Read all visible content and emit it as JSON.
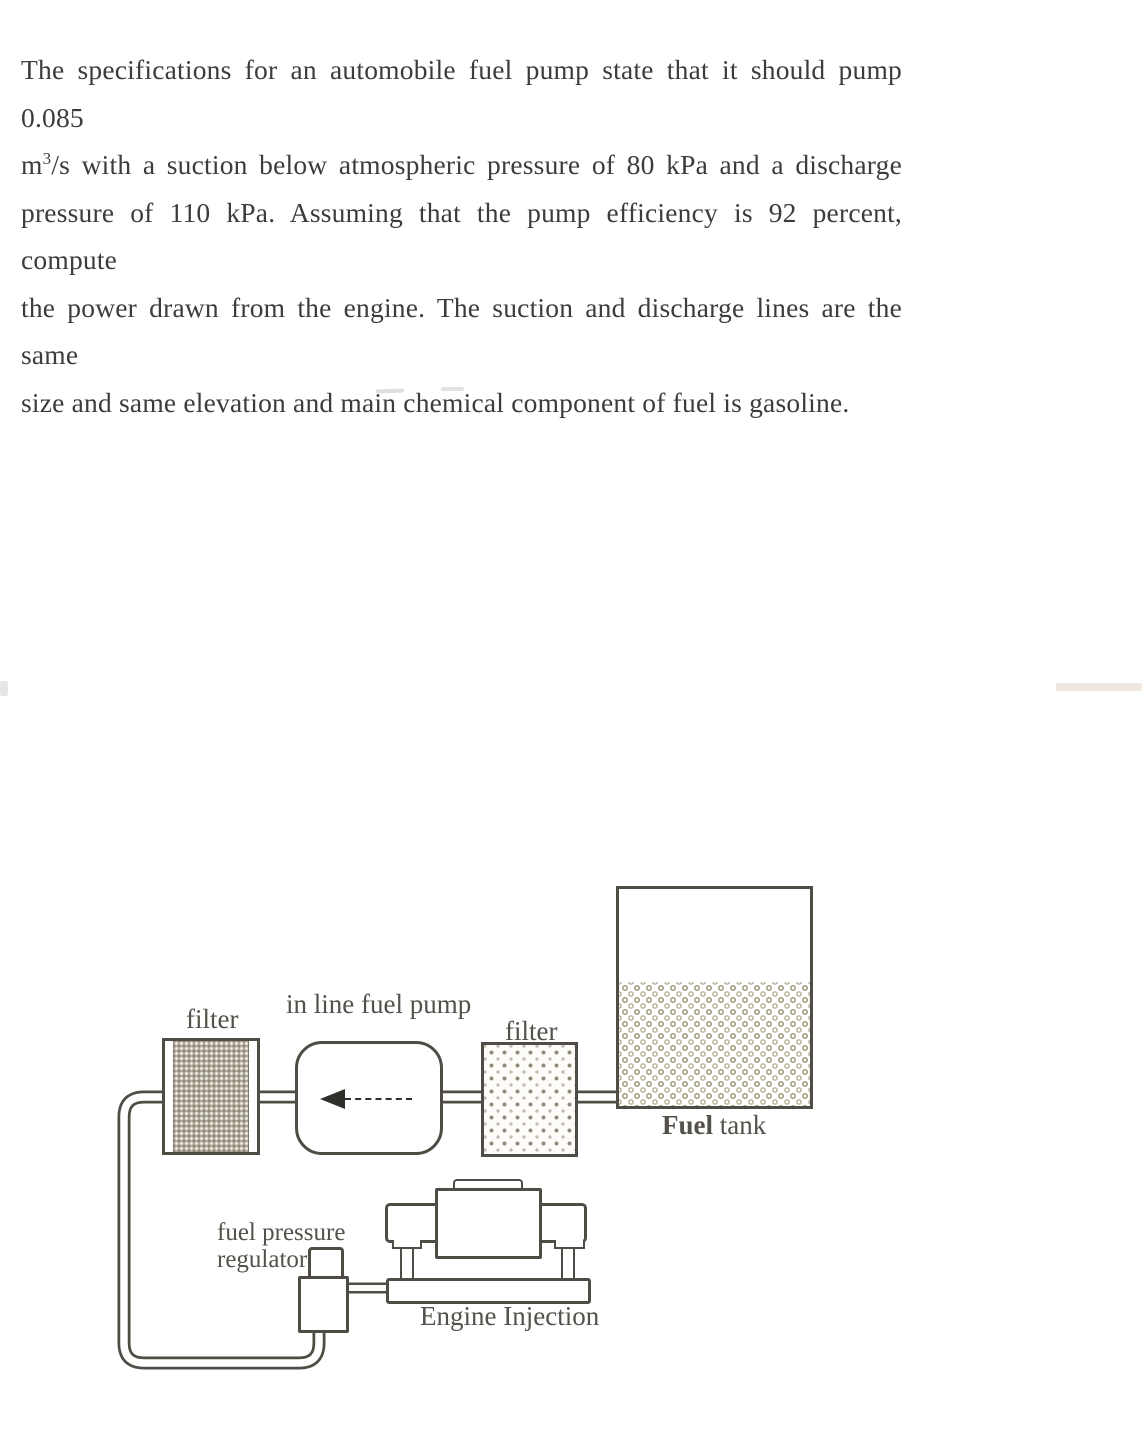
{
  "page": {
    "bg": "#ffffff"
  },
  "problem": {
    "line1": "The specifications for an automobile fuel pump state that it should pump 0.085",
    "line2_pre": "m",
    "line2_sup": "3",
    "line2_post": "/s with a suction below atmospheric pressure of 80 kPa and a discharge",
    "line3": "pressure of 110 kPa. Assuming that the pump efficiency is 92 percent, compute",
    "line4": "the power drawn from the engine. The suction and discharge lines are the same",
    "line5": "size and same elevation and main chemical component of fuel is gasoline."
  },
  "diagram": {
    "filter_left_label": "filter",
    "pump_label": "in line fuel pump",
    "filter_right_label": "filter",
    "tank_label_bold": "Fuel",
    "tank_label_rest": " tank",
    "regulator_label_line1": "fuel pressure",
    "regulator_label_line2": "regulator",
    "engine_label": "Engine Injection",
    "flow_direction": "left",
    "colors": {
      "outline": "#4e4c45",
      "label": "#54514a",
      "filter_left_fill": "#b2aa9a",
      "filter_right_dot": "#8f8a78",
      "tank_ring": "#9e9878",
      "page_bg": "#ffffff"
    }
  }
}
